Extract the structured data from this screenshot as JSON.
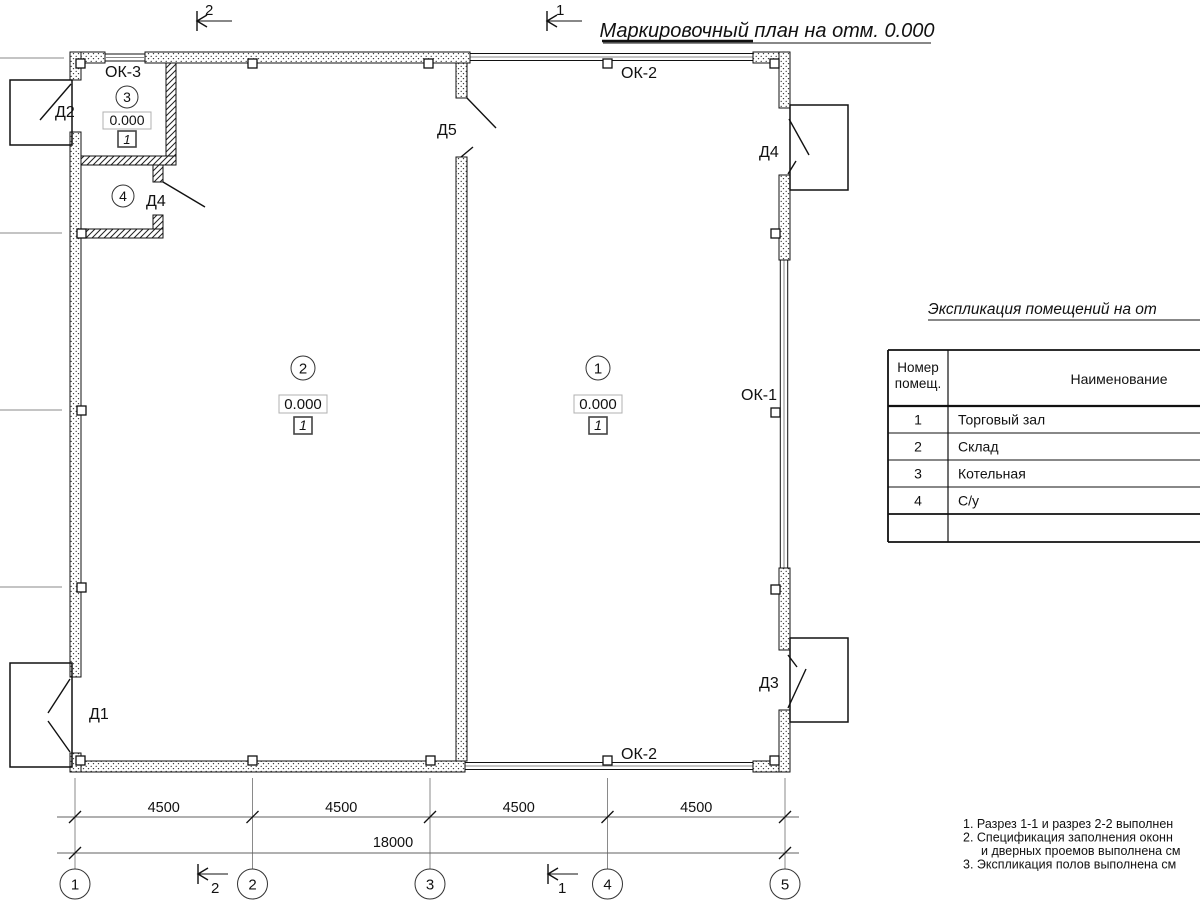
{
  "drawing_title": "Маркировочный план на отм. 0.000",
  "section_marks": {
    "s1": "1",
    "s2": "2"
  },
  "axis_bubbles": [
    "1",
    "2",
    "3",
    "4",
    "5"
  ],
  "dimensions": {
    "segments": [
      "4500",
      "4500",
      "4500",
      "4500"
    ],
    "total": "18000"
  },
  "door_labels": {
    "d1": "Д1",
    "d2": "Д2",
    "d3": "Д3",
    "d4": "Д4",
    "d5": "Д5"
  },
  "window_labels": {
    "ok1": "ОК-1",
    "ok2": "ОК-2",
    "ok3": "ОК-3"
  },
  "room_marks": {
    "room1": {
      "number": "1",
      "elevation": "0.000",
      "floor": "1"
    },
    "room2": {
      "number": "2",
      "elevation": "0.000",
      "floor": "1"
    },
    "room3": {
      "number": "3",
      "elevation": "0.000",
      "floor": "1"
    },
    "room4": {
      "number": "4"
    }
  },
  "legend": {
    "title": "Экспликация помещений на от",
    "header": {
      "num_line1": "Номер",
      "num_line2": "помещ.",
      "name": "Наименование"
    },
    "rows": [
      {
        "num": "1",
        "name": "Торговый зал"
      },
      {
        "num": "2",
        "name": "Склад"
      },
      {
        "num": "3",
        "name": "Котельная"
      },
      {
        "num": "4",
        "name": "С/у"
      }
    ]
  },
  "notes": {
    "line1": "1. Разрез 1-1 и разрез 2-2 выполнен",
    "line2": "2. Спецификация заполнения оконн",
    "line3": "и дверных проемов выполнена см",
    "line4": "3. Экспликация полов выполнена см"
  }
}
